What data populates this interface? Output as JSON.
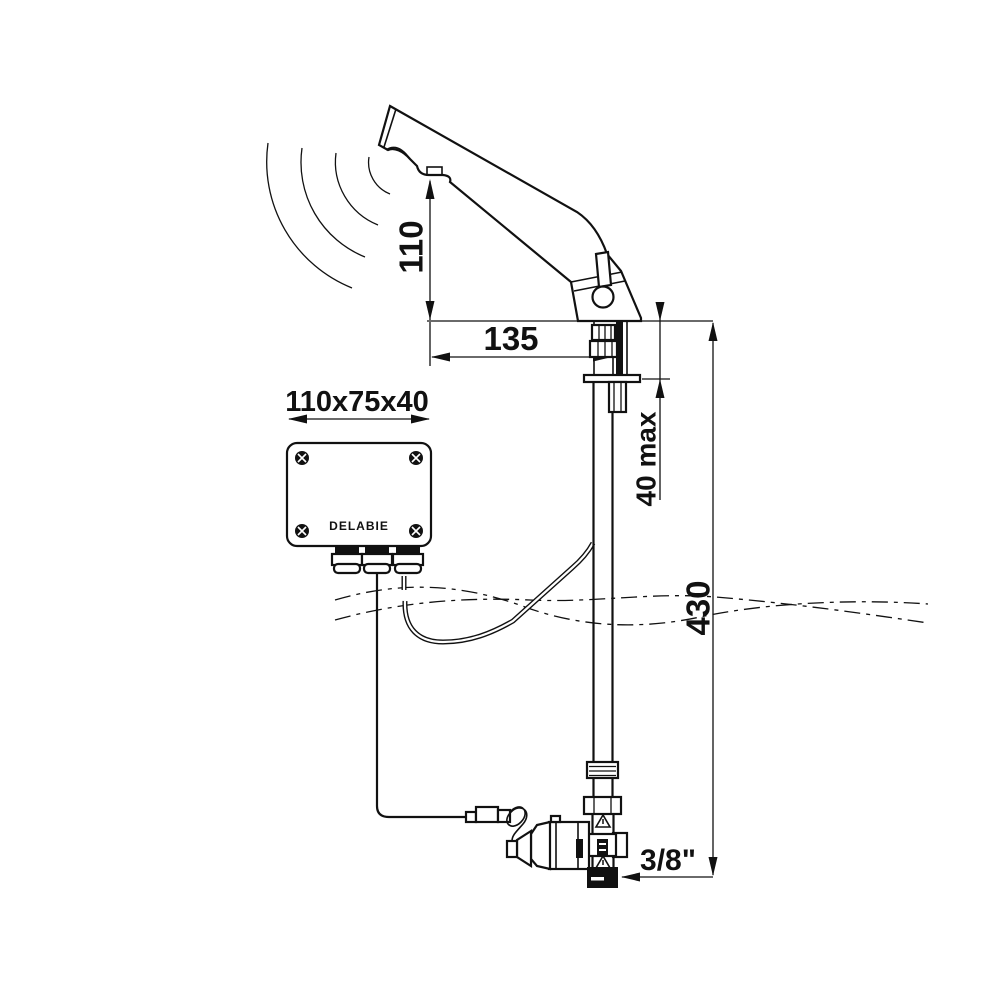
{
  "labels": {
    "spout_height": "110",
    "spout_reach": "135",
    "control_box_size": "110x75x40",
    "control_box_brand": "DELABIE",
    "deck_thickness_max": "40 max",
    "supply_height": "430",
    "connection_size": "3/8\"",
    "valve_brand": "DELABIE"
  },
  "colors": {
    "line": "#111111",
    "background": "#ffffff"
  }
}
